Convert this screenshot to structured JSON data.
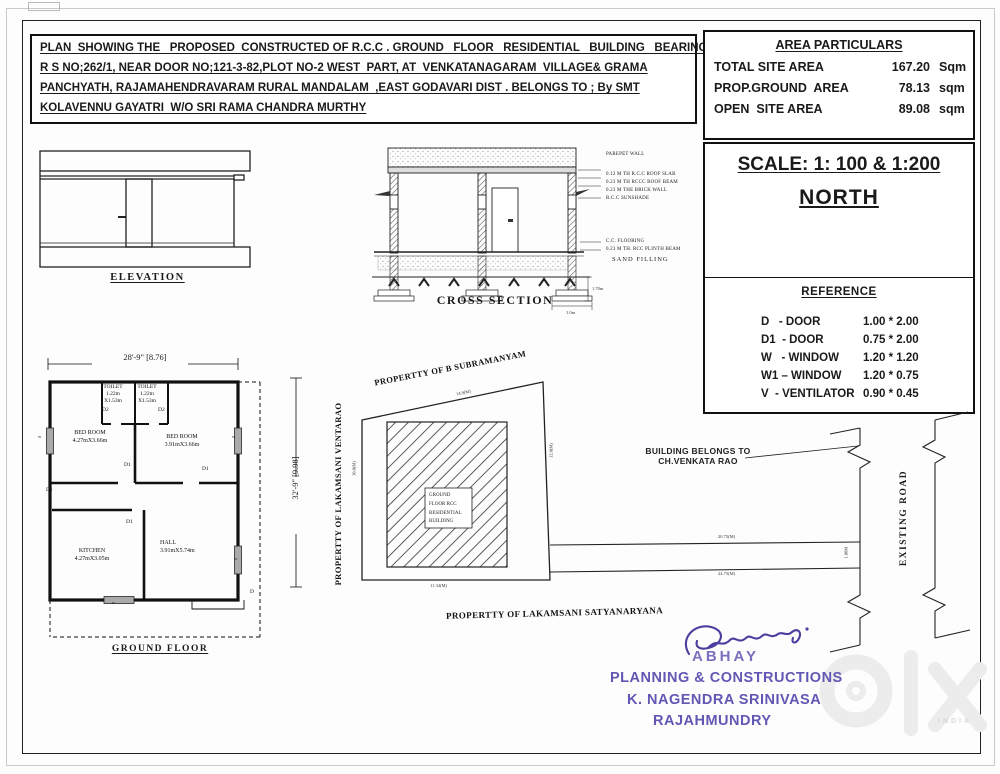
{
  "doc": {
    "title_lines": [
      "PLAN  SHOWING THE   PROPOSED  CONSTRUCTED OF R.C.C . GROUND   FLOOR   RESIDENTIAL   BUILDING   BEARING",
      "R S NO;262/1, NEAR DOOR NO;121-3-82,PLOT NO-2 WEST  PART, AT  VENKATANAGARAM  VILLAGE& GRAMA",
      "PANCHYATH, RAJAMAHENDRAVARAM RURAL MANDALAM  ,EAST GODAVARI DIST . BELONGS TO ; By SMT",
      "KOLAVENNU GAYATRI  W/O SRI RAMA CHANDRA MURTHY"
    ]
  },
  "area_particulars": {
    "title": "AREA PARTICULARS",
    "rows": [
      {
        "label": "TOTAL SITE AREA",
        "value": "167.20",
        "unit": "Sqm"
      },
      {
        "label": "PROP.GROUND  AREA",
        "value": "78.13",
        "unit": "sqm"
      },
      {
        "label": "OPEN  SITE AREA",
        "value": "89.08",
        "unit": "sqm"
      }
    ]
  },
  "scale_box": {
    "scale": "SCALE: 1: 100 & 1:200",
    "north": "NORTH"
  },
  "reference": {
    "title": "REFERENCE",
    "rows": [
      {
        "name": "D   - DOOR",
        "size": "1.00 * 2.00"
      },
      {
        "name": "D1  - DOOR",
        "size": "0.75 * 2.00"
      },
      {
        "name": "W   - WINDOW",
        "size": "1.20 * 1.20"
      },
      {
        "name": "W1 – WINDOW",
        "size": "1.20 * 0.75"
      },
      {
        "name": "V  - VENTILATOR",
        "size": "0.90 * 0.45"
      }
    ]
  },
  "elevation": {
    "label": "ELEVATION"
  },
  "cross_section": {
    "label": "CROSS SECTION",
    "callouts": [
      "PAREPET WALL",
      "0.12 M TH R.C.C ROOF SLAB",
      "0.23 M TH RCCC ROOF BEAM",
      "0.23 M THE BRICK WALL",
      "R.C.C SUNSHADE",
      "C.C. FLOORING",
      "0.23 M TH. RCC PLINTH BEAM",
      "SAND FILLING"
    ],
    "dim_depth": "1.70m",
    "dim_footing": "1.0m"
  },
  "floor_plan": {
    "label": "GROUND FLOOR",
    "width_dim": "28'-9\" [8.76]",
    "height_dim": "32'-9\" [9.98]",
    "toilet_left": {
      "name": "TOILET",
      "l1": "1.22m",
      "l2": "X1.53m"
    },
    "toilet_right": {
      "name": "TOILET",
      "l1": "1.22m",
      "l2": "X1.53m"
    },
    "bed_left": {
      "name": "BED ROOM",
      "dim": "4.27mX3.66m"
    },
    "bed_right": {
      "name": "BED ROOM",
      "dim": "3.91mX3.66m"
    },
    "kitchen": {
      "name": "KITCHEN",
      "dim": "4.27mX3.05m"
    },
    "hall": {
      "name": "HALL",
      "dim": "3.91mX5.74m"
    },
    "marks": {
      "d": "D",
      "d1": "D1",
      "d2": "D2",
      "w": "w"
    }
  },
  "site_plan": {
    "top_property": "PROPERTTY OF B SUBRAMANYAM",
    "left_property": "PROPERTTY OF LAKAMSANI VENTARAO",
    "bottom_property": "PROPERTTY OF LAKAMSANI SATYANARYANA",
    "building_box": {
      "l1": "GROUND",
      "l2": "FLOOR RCC",
      "l3": "RESIDENTIAL",
      "l4": "BUILDING"
    },
    "belongs_l1": "BUILDING BELONGS TO",
    "belongs_l2": "CH.VENKATA RAO",
    "road_label": "EXISTING ROAD",
    "dims": {
      "top": "14.9(M)",
      "left": "10.0(M)",
      "right": "12.0(M)",
      "bottom": "11.34(M)",
      "passage_top": "20.75(M)",
      "passage_bottom": "24.75(M)",
      "lane": "1.00M"
    }
  },
  "stamp": {
    "l1": "ABHAY",
    "l2": "PLANNING & CONSTRUCTIONS",
    "l3": "K. NAGENDRA SRINIVASA",
    "l4": "RAJAHMUNDRY"
  },
  "watermark": {
    "sub": "INDIA"
  }
}
